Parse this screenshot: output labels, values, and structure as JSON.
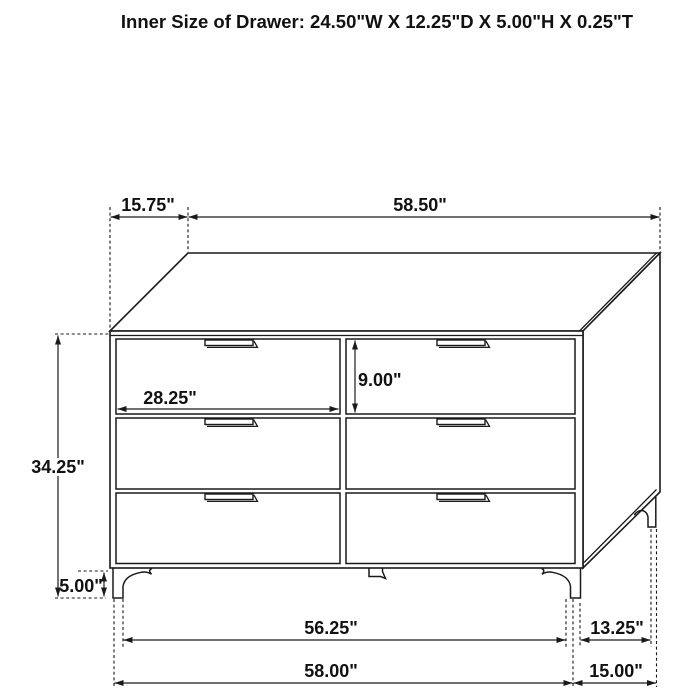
{
  "title": "Inner Size of Drawer: 24.50\"W X 12.25\"D X 5.00\"H X 0.25\"T",
  "figure": {
    "kind": "furniture dimension line drawing",
    "item": "6-drawer dresser, three-quarter perspective view"
  },
  "dimensions": {
    "top_side_offset": "15.75\"",
    "top_width": "58.50\"",
    "body_height": "34.25\"",
    "leg_height": "5.00\"",
    "drawer_front_width": "28.25\"",
    "drawer_front_height": "9.00\"",
    "front_leg_span": "56.25\"",
    "front_width_overall": "58.00\"",
    "side_leg_span": "13.25\"",
    "side_depth_overall": "15.00\""
  },
  "colors": {
    "ink": "#1a1a1a",
    "background": "#ffffff"
  }
}
